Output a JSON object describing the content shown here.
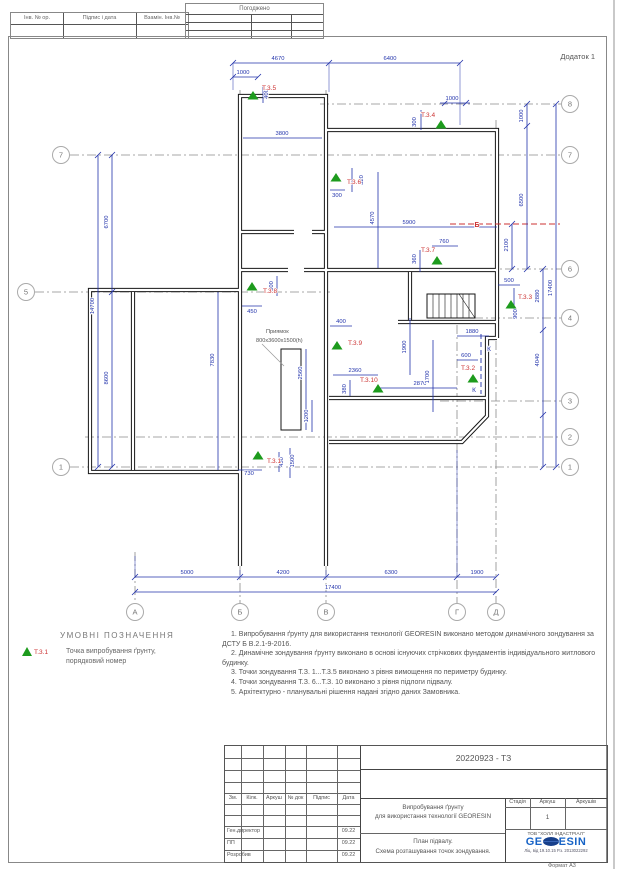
{
  "page": {
    "appendix": "Додаток 1",
    "format_note": "Формат А3"
  },
  "top_stamps": {
    "left_cells": [
      "Інв. № ор.",
      "Підпис і дата",
      "Взамін. Інв.№"
    ],
    "approved_label": "Погоджено"
  },
  "legend": {
    "title": "УМОВНІ ПОЗНАЧЕННЯ",
    "symbol_label": "Т.3.1",
    "symbol_desc_line1": "Точка випробування ґрунту,",
    "symbol_desc_line2": "порядковий номер"
  },
  "notes": [
    "1.  Випробування ґрунту для використання технології GEORESIN  виконано методом динамічного зондування за ДСТУ Б В.2.1-9-2016.",
    "2.  Динамічне зондування ґрунту виконано в основі існуючих стрічкових фундаментів індивідуального житлового будинку.",
    "3.  Точки зондування Т.З. 1...Т.3.5 виконано з рівня вимощення по периметру будинку.",
    "4.  Точки зондування Т.З. 6...Т.З. 10 виконано з рівня підлоги підвалу.",
    "5.  Архітектурно - планувальні рішення надані згідно даних Замовника."
  ],
  "plan": {
    "axis_bubbles": [
      {
        "label": "7",
        "x": 61,
        "y": 155
      },
      {
        "label": "5",
        "x": 26,
        "y": 292
      },
      {
        "label": "1",
        "x": 61,
        "y": 467
      },
      {
        "label": "8",
        "x": 570,
        "y": 104
      },
      {
        "label": "7",
        "x": 570,
        "y": 155
      },
      {
        "label": "6",
        "x": 570,
        "y": 269
      },
      {
        "label": "4",
        "x": 570,
        "y": 318
      },
      {
        "label": "3",
        "x": 570,
        "y": 401
      },
      {
        "label": "2",
        "x": 570,
        "y": 437
      },
      {
        "label": "1",
        "x": 570,
        "y": 467
      },
      {
        "label": "А",
        "x": 135,
        "y": 612
      },
      {
        "label": "Б",
        "x": 240,
        "y": 612
      },
      {
        "label": "В",
        "x": 326,
        "y": 612
      },
      {
        "label": "Г",
        "x": 457,
        "y": 612
      },
      {
        "label": "Д",
        "x": 496,
        "y": 612
      }
    ],
    "test_points": [
      {
        "label": "Т.3.5",
        "x": 253,
        "y": 96,
        "lx": 262,
        "ly": 90
      },
      {
        "label": "Т.3.4",
        "x": 441,
        "y": 125,
        "lx": 421,
        "ly": 117
      },
      {
        "label": "Т.3.6",
        "x": 336,
        "y": 178,
        "lx": 347,
        "ly": 184
      },
      {
        "label": "Т.3.7",
        "x": 437,
        "y": 261,
        "lx": 421,
        "ly": 252
      },
      {
        "label": "Т.3.8",
        "x": 252,
        "y": 287,
        "lx": 263,
        "ly": 293
      },
      {
        "label": "Т.3.3",
        "x": 511,
        "y": 305,
        "lx": 518,
        "ly": 299
      },
      {
        "label": "Т.3.9",
        "x": 337,
        "y": 346,
        "lx": 348,
        "ly": 345
      },
      {
        "label": "Т.3.2",
        "x": 473,
        "y": 379,
        "lx": 461,
        "ly": 370
      },
      {
        "label": "Т.3.10",
        "x": 378,
        "y": 389,
        "lx": 360,
        "ly": 382
      },
      {
        "label": "Т.3.1",
        "x": 258,
        "y": 456,
        "lx": 267,
        "ly": 463
      }
    ],
    "dim_labels": [
      {
        "t": "4670",
        "x": 278,
        "y": 60
      },
      {
        "t": "6400",
        "x": 390,
        "y": 60
      },
      {
        "t": "1000",
        "x": 243,
        "y": 74
      },
      {
        "t": "400",
        "x": 268,
        "y": 94,
        "r": 1
      },
      {
        "t": "1000",
        "x": 452,
        "y": 100
      },
      {
        "t": "300",
        "x": 416,
        "y": 122,
        "r": 1
      },
      {
        "t": "3800",
        "x": 282,
        "y": 135
      },
      {
        "t": "1000",
        "x": 523,
        "y": 116,
        "r": 1
      },
      {
        "t": "6500",
        "x": 523,
        "y": 200,
        "r": 1
      },
      {
        "t": "2100",
        "x": 508,
        "y": 245,
        "r": 1
      },
      {
        "t": "2880",
        "x": 539,
        "y": 296,
        "r": 1
      },
      {
        "t": "4040",
        "x": 539,
        "y": 360,
        "r": 1
      },
      {
        "t": "17400",
        "x": 552,
        "y": 288,
        "r": 1
      },
      {
        "t": "6700",
        "x": 108,
        "y": 222,
        "r": 1
      },
      {
        "t": "14700",
        "x": 94,
        "y": 306,
        "r": 1
      },
      {
        "t": "8600",
        "x": 108,
        "y": 378,
        "r": 1
      },
      {
        "t": "5000",
        "x": 187,
        "y": 574
      },
      {
        "t": "4200",
        "x": 283,
        "y": 574
      },
      {
        "t": "6300",
        "x": 391,
        "y": 574
      },
      {
        "t": "1900",
        "x": 477,
        "y": 574
      },
      {
        "t": "17400",
        "x": 333,
        "y": 589
      },
      {
        "t": "320",
        "x": 363,
        "y": 180,
        "r": 1
      },
      {
        "t": "300",
        "x": 337,
        "y": 197
      },
      {
        "t": "4570",
        "x": 374,
        "y": 218,
        "r": 1
      },
      {
        "t": "5900",
        "x": 409,
        "y": 224
      },
      {
        "t": "760",
        "x": 444,
        "y": 243
      },
      {
        "t": "360",
        "x": 416,
        "y": 259,
        "r": 1
      },
      {
        "t": "500",
        "x": 273,
        "y": 286,
        "r": 1
      },
      {
        "t": "450",
        "x": 252,
        "y": 313
      },
      {
        "t": "7830",
        "x": 214,
        "y": 360,
        "r": 1
      },
      {
        "t": "400",
        "x": 341,
        "y": 323
      },
      {
        "t": "2560",
        "x": 302,
        "y": 373,
        "r": 1
      },
      {
        "t": "2360",
        "x": 355,
        "y": 372
      },
      {
        "t": "380",
        "x": 346,
        "y": 389,
        "r": 1
      },
      {
        "t": "1900",
        "x": 406,
        "y": 347,
        "r": 1
      },
      {
        "t": "2870",
        "x": 420,
        "y": 385
      },
      {
        "t": "1700",
        "x": 429,
        "y": 377,
        "r": 1
      },
      {
        "t": "1880",
        "x": 472,
        "y": 333
      },
      {
        "t": "600",
        "x": 466,
        "y": 357
      },
      {
        "t": "500",
        "x": 509,
        "y": 282
      },
      {
        "t": "900",
        "x": 517,
        "y": 314,
        "r": 1
      },
      {
        "t": "730",
        "x": 249,
        "y": 475
      },
      {
        "t": "450",
        "x": 283,
        "y": 462,
        "r": 1
      },
      {
        "t": "1500",
        "x": 294,
        "y": 461,
        "r": 1
      },
      {
        "t": "1200",
        "x": 308,
        "y": 416,
        "r": 1
      }
    ],
    "section_marks": [
      {
        "t": "Б",
        "x": 477,
        "y": 227,
        "c": "red"
      },
      {
        "t": "К",
        "x": 489,
        "y": 351,
        "c": "blue"
      },
      {
        "t": "К",
        "x": 474,
        "y": 392,
        "c": "blue"
      }
    ],
    "annotations": [
      {
        "t": "Приямок",
        "x": 266,
        "y": 333
      },
      {
        "t": "800х3600х1500(h)",
        "x": 256,
        "y": 342
      }
    ]
  },
  "title_block": {
    "doc_number": "20220923 - ТЗ",
    "header_cols": [
      "Зм.",
      "Кілк.",
      "Аркуш",
      "№ док",
      "Підпис",
      "Дата"
    ],
    "rows": [
      {
        "role": "Ген.директор",
        "date": "09.22"
      },
      {
        "role": "ПП",
        "date": "09.22"
      },
      {
        "role": "Розробив",
        "date": "09.22"
      }
    ],
    "title_line1": "Випробування ґрунту",
    "title_line2": "для використання технології GEORESIN",
    "subtitle_line1": "План підвалу.",
    "subtitle_line2": "Схема розташування точок зондування.",
    "stage_label": "Стадія",
    "sheet_label": "Аркуш",
    "sheets_label": "Аркушів",
    "sheet_number": "1",
    "company": "ТОВ \"ХОЛЛ ІНДАСТРІАЛ\"",
    "logo_left": "GE",
    "logo_right": "ESIN",
    "license": "Ліц. від 19.10.15 Р.з. 2013022292"
  },
  "colors": {
    "dim_blue": "#2233ab",
    "point_green": "#1d9b1d",
    "label_red": "#cc3333",
    "logo_blue": "#1763c6",
    "logo_dark": "#173f8a"
  }
}
